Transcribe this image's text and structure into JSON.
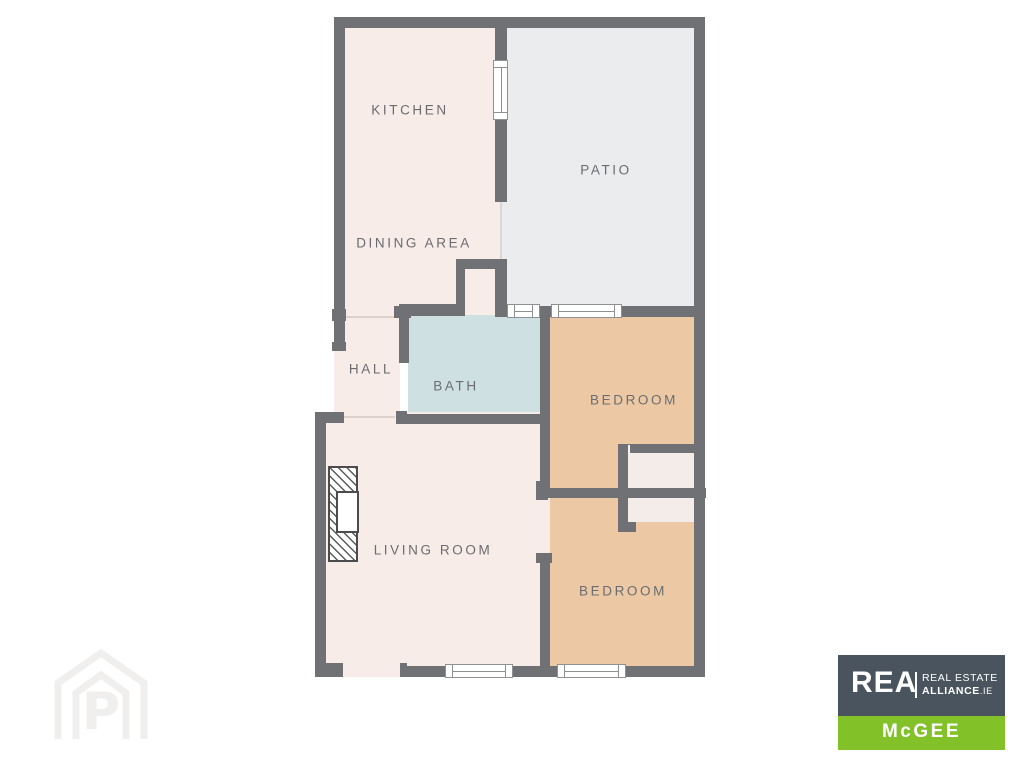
{
  "floorplan": {
    "rooms": [
      {
        "id": "kitchen",
        "label": "KITCHEN"
      },
      {
        "id": "patio",
        "label": "PATIO"
      },
      {
        "id": "dining",
        "label": "DINING AREA"
      },
      {
        "id": "hall",
        "label": "HALL"
      },
      {
        "id": "bath",
        "label": "BATH"
      },
      {
        "id": "bedroom-1",
        "label": "BEDROOM"
      },
      {
        "id": "living",
        "label": "LIVING ROOM"
      },
      {
        "id": "bedroom-2",
        "label": "BEDROOM"
      }
    ],
    "colors": {
      "wall": "#707175",
      "room_cream": "#f7ece7",
      "patio_gray": "#ebecee",
      "bath_blue": "#cfe0e2",
      "bedroom_peach": "#ecc9a4",
      "closet_cream": "#f4ece9",
      "label_text": "#696d71"
    }
  },
  "branding": {
    "agency_logo": {
      "name": "REA",
      "line1": "REAL ESTATE",
      "line2": "ALLIANCE",
      "line2_suffix": ".IE",
      "office": "McGEE",
      "colors": {
        "box": "#4a545e",
        "band": "#82c128",
        "text": "#ffffff"
      }
    },
    "watermark": {
      "letter": "P"
    }
  }
}
